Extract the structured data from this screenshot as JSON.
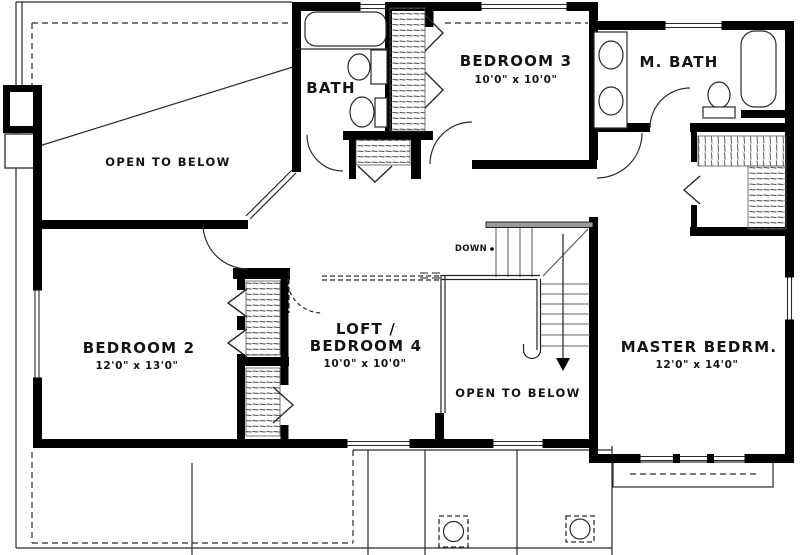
{
  "plan": {
    "areas": {
      "open_to_below_upper": {
        "label": "OPEN TO BELOW"
      },
      "bath": {
        "label": "BATH"
      },
      "bedroom3": {
        "label": "BEDROOM 3",
        "dims": "10'0\" x 10'0\""
      },
      "master_bath": {
        "label": "M. BATH"
      },
      "bedroom2": {
        "label": "BEDROOM 2",
        "dims": "12'0\" x 13'0\""
      },
      "loft": {
        "label_line1": "LOFT /",
        "label_line2": "BEDROOM 4",
        "dims": "10'0\" x 10'0\""
      },
      "open_to_below_lower": {
        "label": "OPEN TO BELOW"
      },
      "master_bedroom": {
        "label": "MASTER BEDRM.",
        "dims": "12'0\" x 14'0\""
      }
    },
    "stairs": {
      "label": "DOWN"
    },
    "colors": {
      "wall": "#000000",
      "line": "#2a2a2a",
      "background": "#ffffff"
    }
  }
}
